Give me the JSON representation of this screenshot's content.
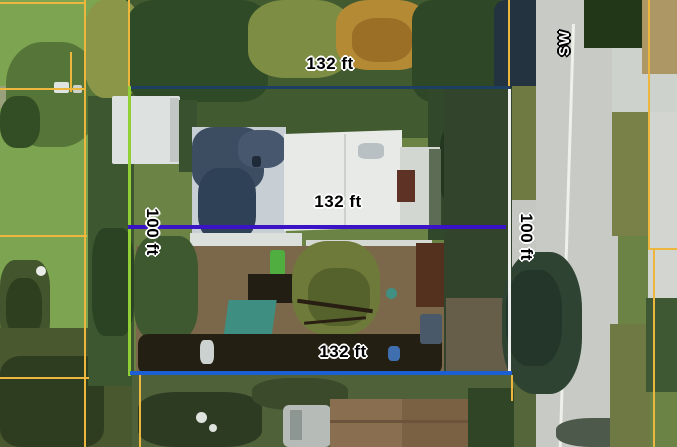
{
  "map": {
    "labels": {
      "width_top": "132 ft",
      "width_middle": "132 ft",
      "width_bottom": "132 ft",
      "height_left": "100 ft",
      "height_right": "100 ft",
      "street_name": "SW"
    },
    "colors": {
      "parcel_boundary": "#edb73d",
      "measure_top_line": "#1d3f62",
      "measure_middle_line": "#3a13c6",
      "measure_bottom_line": "#1c5fd3",
      "measure_left_line": "#92cf36",
      "measure_right_line": "#edf0ee",
      "road_centerline": "#eef0ea"
    }
  }
}
